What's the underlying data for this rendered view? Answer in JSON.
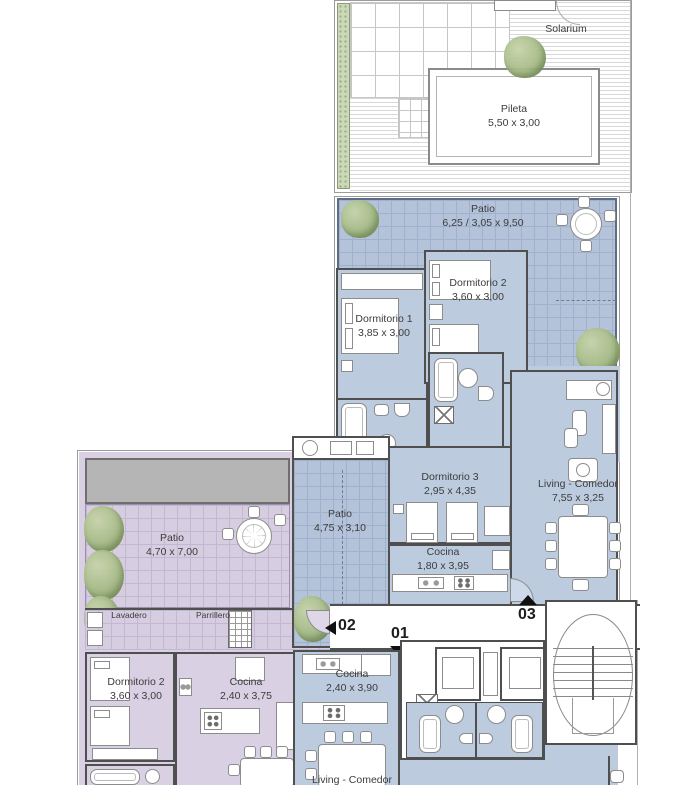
{
  "plan_title": "Floor plan",
  "rooms": {
    "solarium": {
      "name": "Solarium",
      "dims": ""
    },
    "pileta": {
      "name": "Pileta",
      "dims": "5,50 x 3,00"
    },
    "patio_upper": {
      "name": "Patio",
      "dims": "6,25 / 3,05 x 9,50"
    },
    "dormitorio2_up": {
      "name": "Dormitorio 2",
      "dims": "3,60 x 3,00"
    },
    "dormitorio1": {
      "name": "Dormitorio 1",
      "dims": "3,85 x 3,00"
    },
    "dormitorio3": {
      "name": "Dormitorio 3",
      "dims": "2,95 x 4,35"
    },
    "living_upper": {
      "name": "Living - Comedor",
      "dims": "7,55 x 3,25"
    },
    "cocina_upper": {
      "name": "Cocina",
      "dims": "1,80 x 3,95"
    },
    "patio_left": {
      "name": "Patio",
      "dims": "4,70 x 7,00"
    },
    "patio_mid": {
      "name": "Patio",
      "dims": "4,75 x 3,10"
    },
    "lavadero": {
      "name": "Lavadero",
      "dims": ""
    },
    "parrillero": {
      "name": "Parrillero",
      "dims": ""
    },
    "dormitorio2_low": {
      "name": "Dormitorio 2",
      "dims": "3,60 x 3,00"
    },
    "cocina_left": {
      "name": "Cocina",
      "dims": "2,40 x 3,75"
    },
    "cocina_lower": {
      "name": "Cocina",
      "dims": "2,40 x 3,90"
    },
    "living_lower": {
      "name": "Living - Comedor",
      "dims": ""
    }
  },
  "units": {
    "u01": "01",
    "u02": "02",
    "u03": "03"
  },
  "colors": {
    "room_blue": "#bdcbdf",
    "patio_blue_tile": "#b4c3d9",
    "unit_purple": "#d9d1e3",
    "patio_purple_tile": "#d6cde1",
    "terrace_gray": "#b5b5b5",
    "garden_green": "#ccd8ba",
    "wall": "#4f4f4f"
  }
}
